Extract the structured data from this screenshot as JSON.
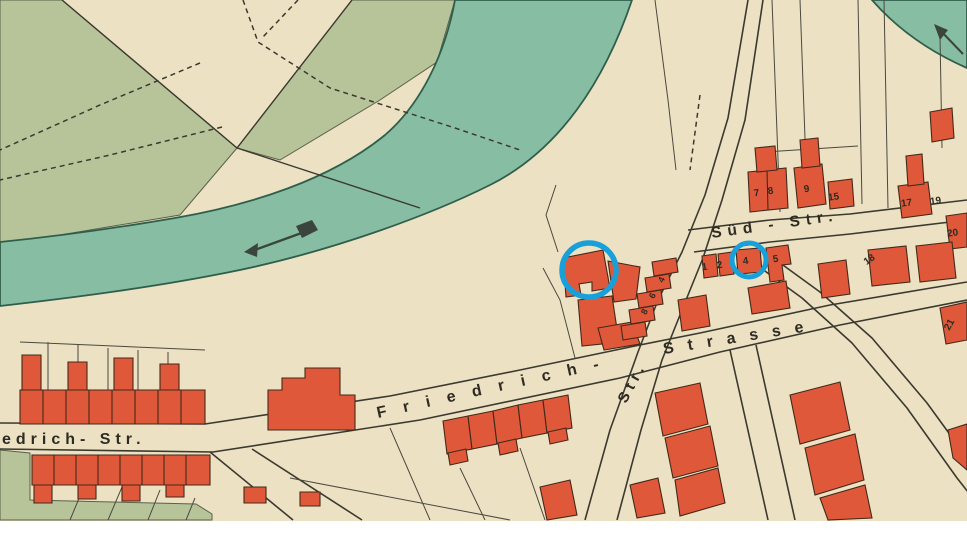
{
  "map": {
    "type": "historical-city-plan",
    "street_labels": {
      "friedrich_partial": "edrich- Str.",
      "friedrich": "Friedrich-",
      "cross_abbrev": "Str.",
      "strasse": "Strasse",
      "sued": "Süd - Str."
    },
    "house_numbers": [
      {
        "value": "1"
      },
      {
        "value": "2"
      },
      {
        "value": "4"
      },
      {
        "value": "5"
      },
      {
        "value": "4"
      },
      {
        "value": "6"
      },
      {
        "value": "8"
      },
      {
        "value": "7"
      },
      {
        "value": "8"
      },
      {
        "value": "9"
      },
      {
        "value": "15"
      },
      {
        "value": "17"
      },
      {
        "value": "19"
      },
      {
        "value": "20"
      },
      {
        "value": "18"
      },
      {
        "value": "21"
      }
    ],
    "annotations": {
      "highlight_circle_count": 2,
      "highlight_color": "#18a0da"
    },
    "features": {
      "river_flow_arrows": 2
    },
    "colors": {
      "paper": "#ece1c3",
      "meadow": "#b7c49a",
      "meadow_edge": "#59614a",
      "river": "#87bda2",
      "river_edge": "#2f5f4c",
      "building": "#e0583a",
      "building_edge": "#43291a",
      "line": "#3b3930",
      "label": "#2e2b22",
      "arrow": "#3a463d"
    }
  }
}
